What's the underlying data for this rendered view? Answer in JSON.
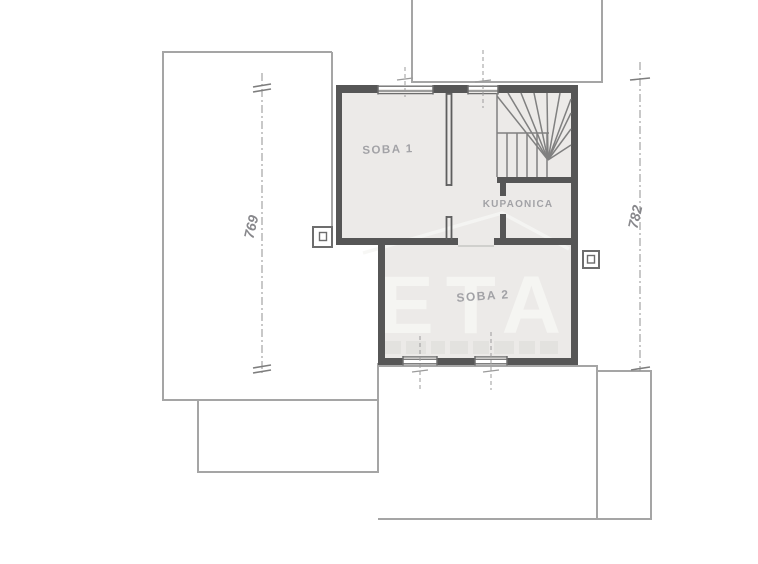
{
  "drawing": {
    "kind": "hand-drawn architectural floor plan",
    "rooms": {
      "soba1": "SOBA 1",
      "kupaonica": "KUPAONICA",
      "soba2": "SOBA 2"
    },
    "dimensions": {
      "left_height": "769",
      "right_height": "782"
    },
    "watermark": {
      "text": "ETA"
    },
    "colors": {
      "background": "#ffffff",
      "wall": "#565656",
      "interior_wall_line": "#5e5e5e",
      "thin_outline": "#a5a5a5",
      "room_fill": "#eceae8",
      "stair_line": "#808080",
      "label": "#a2a2a6",
      "dimension": "#8c8c8c",
      "watermark": "#f6f6f3"
    }
  }
}
